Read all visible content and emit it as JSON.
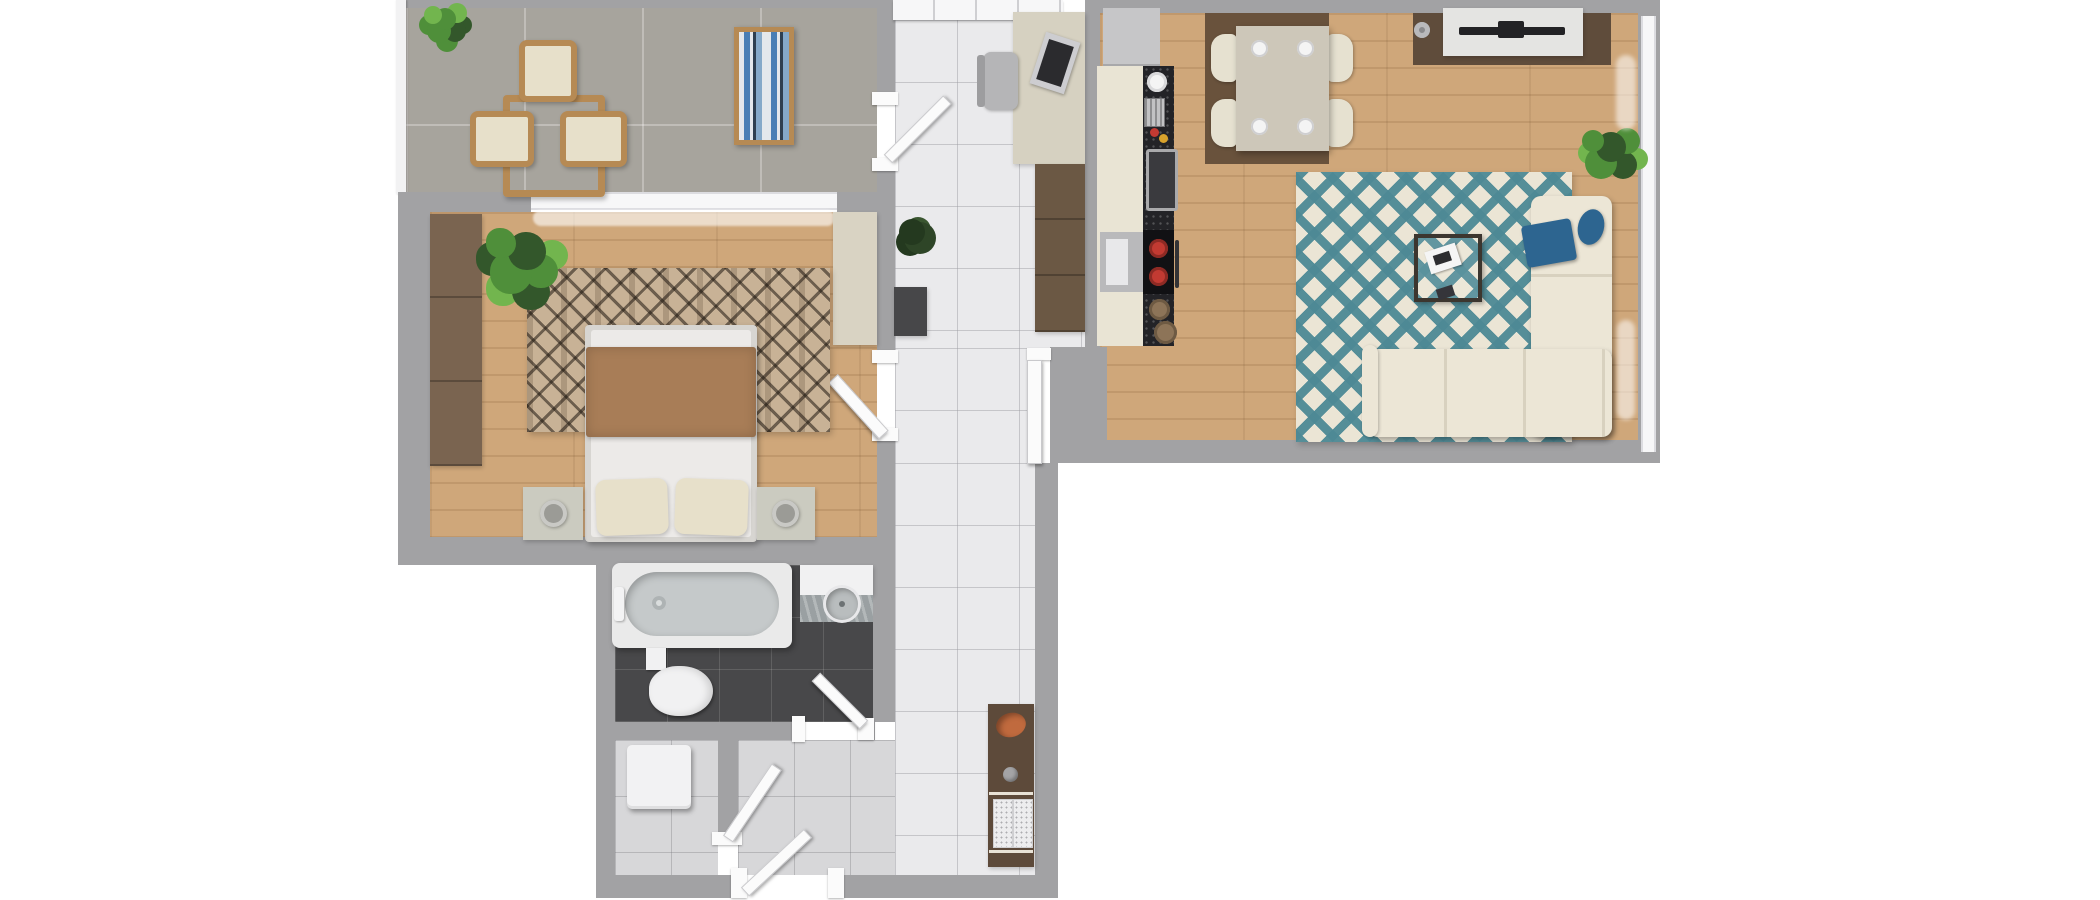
{
  "scene": {
    "title": "apartment-floor-plan-top-view",
    "canvas": {
      "width": 2100,
      "height": 900
    }
  },
  "rooms": [
    {
      "id": "balcony",
      "label": "Balcony"
    },
    {
      "id": "bedroom",
      "label": "Bedroom"
    },
    {
      "id": "entrance-hall",
      "label": "Entrance hall"
    },
    {
      "id": "hallway",
      "label": "Hallway"
    },
    {
      "id": "living-room-kitchen",
      "label": "Living room with kitchen"
    },
    {
      "id": "bathroom",
      "label": "Bathroom"
    },
    {
      "id": "utility-room",
      "label": "Utility room"
    }
  ],
  "furniture": {
    "balcony": [
      "potted-plant",
      "outdoor-table",
      "outdoor-chair x3",
      "sun-lounger"
    ],
    "bedroom": [
      "wardrobe",
      "window-curtain",
      "built-in-closet",
      "area-rug",
      "double-bed",
      "blanket",
      "pillow x2",
      "nightstand x2",
      "table-lamp x2",
      "potted-plant",
      "door"
    ],
    "entrance-hall": [
      "glazed-entry-door",
      "desk",
      "laptop",
      "office-chair",
      "wardrobe",
      "potted-plant",
      "doormat",
      "balcony-door"
    ],
    "living-room-kitchen": [
      "fridge",
      "kitchen-cabinets",
      "countertop",
      "sink",
      "cooktop",
      "pot x2",
      "oven",
      "dish-rack",
      "plate",
      "bowls",
      "dining-mat",
      "dining-table",
      "dining-chair x4",
      "place-setting x4",
      "tv-mat",
      "tv-console",
      "television",
      "speaker",
      "diamond-rug",
      "coffee-table",
      "magazine",
      "corner-sofa",
      "blue-throw",
      "blue-pillow",
      "potted-plant",
      "window-wall"
    ],
    "bathroom": [
      "bathtub",
      "faucet",
      "vanity-counter",
      "washbasin",
      "toilet",
      "door"
    ],
    "utility-room": [
      "washing-machine",
      "door"
    ],
    "hallway": [
      "console-cabinet",
      "decor-bowl",
      "decor-sphere",
      "bench-cushion x2",
      "entrance-door"
    ]
  },
  "colors": {
    "outside": "#ffffff",
    "wall": "#a2a2a4",
    "balcony_floor": "#a7a49d",
    "balcony_line": "rgba(255,255,255,0.28)",
    "wood": "#cfa77a",
    "wood_line": "rgba(101,62,25,0.14)",
    "wood_joint": "rgba(60,35,10,0.08)",
    "tile_white": "#eaeaec",
    "tile_white_line": "rgba(160,160,165,0.5)",
    "tile_dark": "#48484a",
    "tile_dark_line": "rgba(255,255,255,0.13)",
    "tile_light": "#d7d7d9",
    "tile_light_line": "rgba(120,120,125,0.35)",
    "window_white": "#f7f7f8",
    "door_white": "#fbfbfb",
    "door_edge": "#c9c9cc",
    "rail_white": "#f2f2f3",
    "rug_bed_base": "#c8b296",
    "rug_bed_pattern": "rgba(32,24,17,0.55)",
    "rug_living_base": "#ebe5d5",
    "rug_living_pattern": "rgba(77,137,149,0.95)",
    "sofa": "#ece6d6",
    "sofa_edge": "#d8d1bf",
    "accent_blue": "#2d6590",
    "bed_frame": "#d7d5d1",
    "mattress": "#eceae8",
    "blanket": "#a87d57",
    "pillow": "#e7e0ca",
    "nightstand": "#cbcbc0",
    "lamp": "#9b9b96",
    "wardrobe_dark": "#7a6450",
    "wardrobe_entry": "#6b5844",
    "closet_beige": "#d9d3c3",
    "desk": "#d6d1c1",
    "chair_gray": "#b5b5b7",
    "laptop_dark": "#2b2b2e",
    "laptop_silver": "#cdcdd0",
    "mat_dark": "#474749",
    "dining_mat": "#69523c",
    "dining_table": "#cdc7b9",
    "chair_cream": "#e6e1d0",
    "plate_white": "#f4f4f4",
    "tv_mat": "#5f4c3b",
    "tv_console": "#e4e4e2",
    "tv_black": "#222225",
    "kitchen_cabinet": "#e9e4d4",
    "kitchen_counter": "#232327",
    "counter_speck": "rgba(255,255,255,0.22)",
    "appliance_gray": "#c6c6c8",
    "oven_silver": "#b9b9bb",
    "sink_steel": "#a9a9ab",
    "pot_red": "#c23a32",
    "bowl_wood": "#8d7458",
    "console_brown": "#5d4a3a",
    "bowl_orange": "#c06a3e",
    "cushion_speck": "#ededee",
    "bath_white": "#eaeaea",
    "tub_inner": "#c5c9ca",
    "stone": "#9aa0a2",
    "toilet_white": "#f1f1f2",
    "rattan": "#b68a54",
    "stripe_blue": "#4a7fb5",
    "stripe_navy": "#2e3f50",
    "stripe_pale": "#e4e8ec",
    "stripe_mid": "#85a9c9",
    "plant_green": "#4f8f3a",
    "plant_light": "#72b54e",
    "plant_dark": "#33572b",
    "plant_darker": "#24391f"
  }
}
